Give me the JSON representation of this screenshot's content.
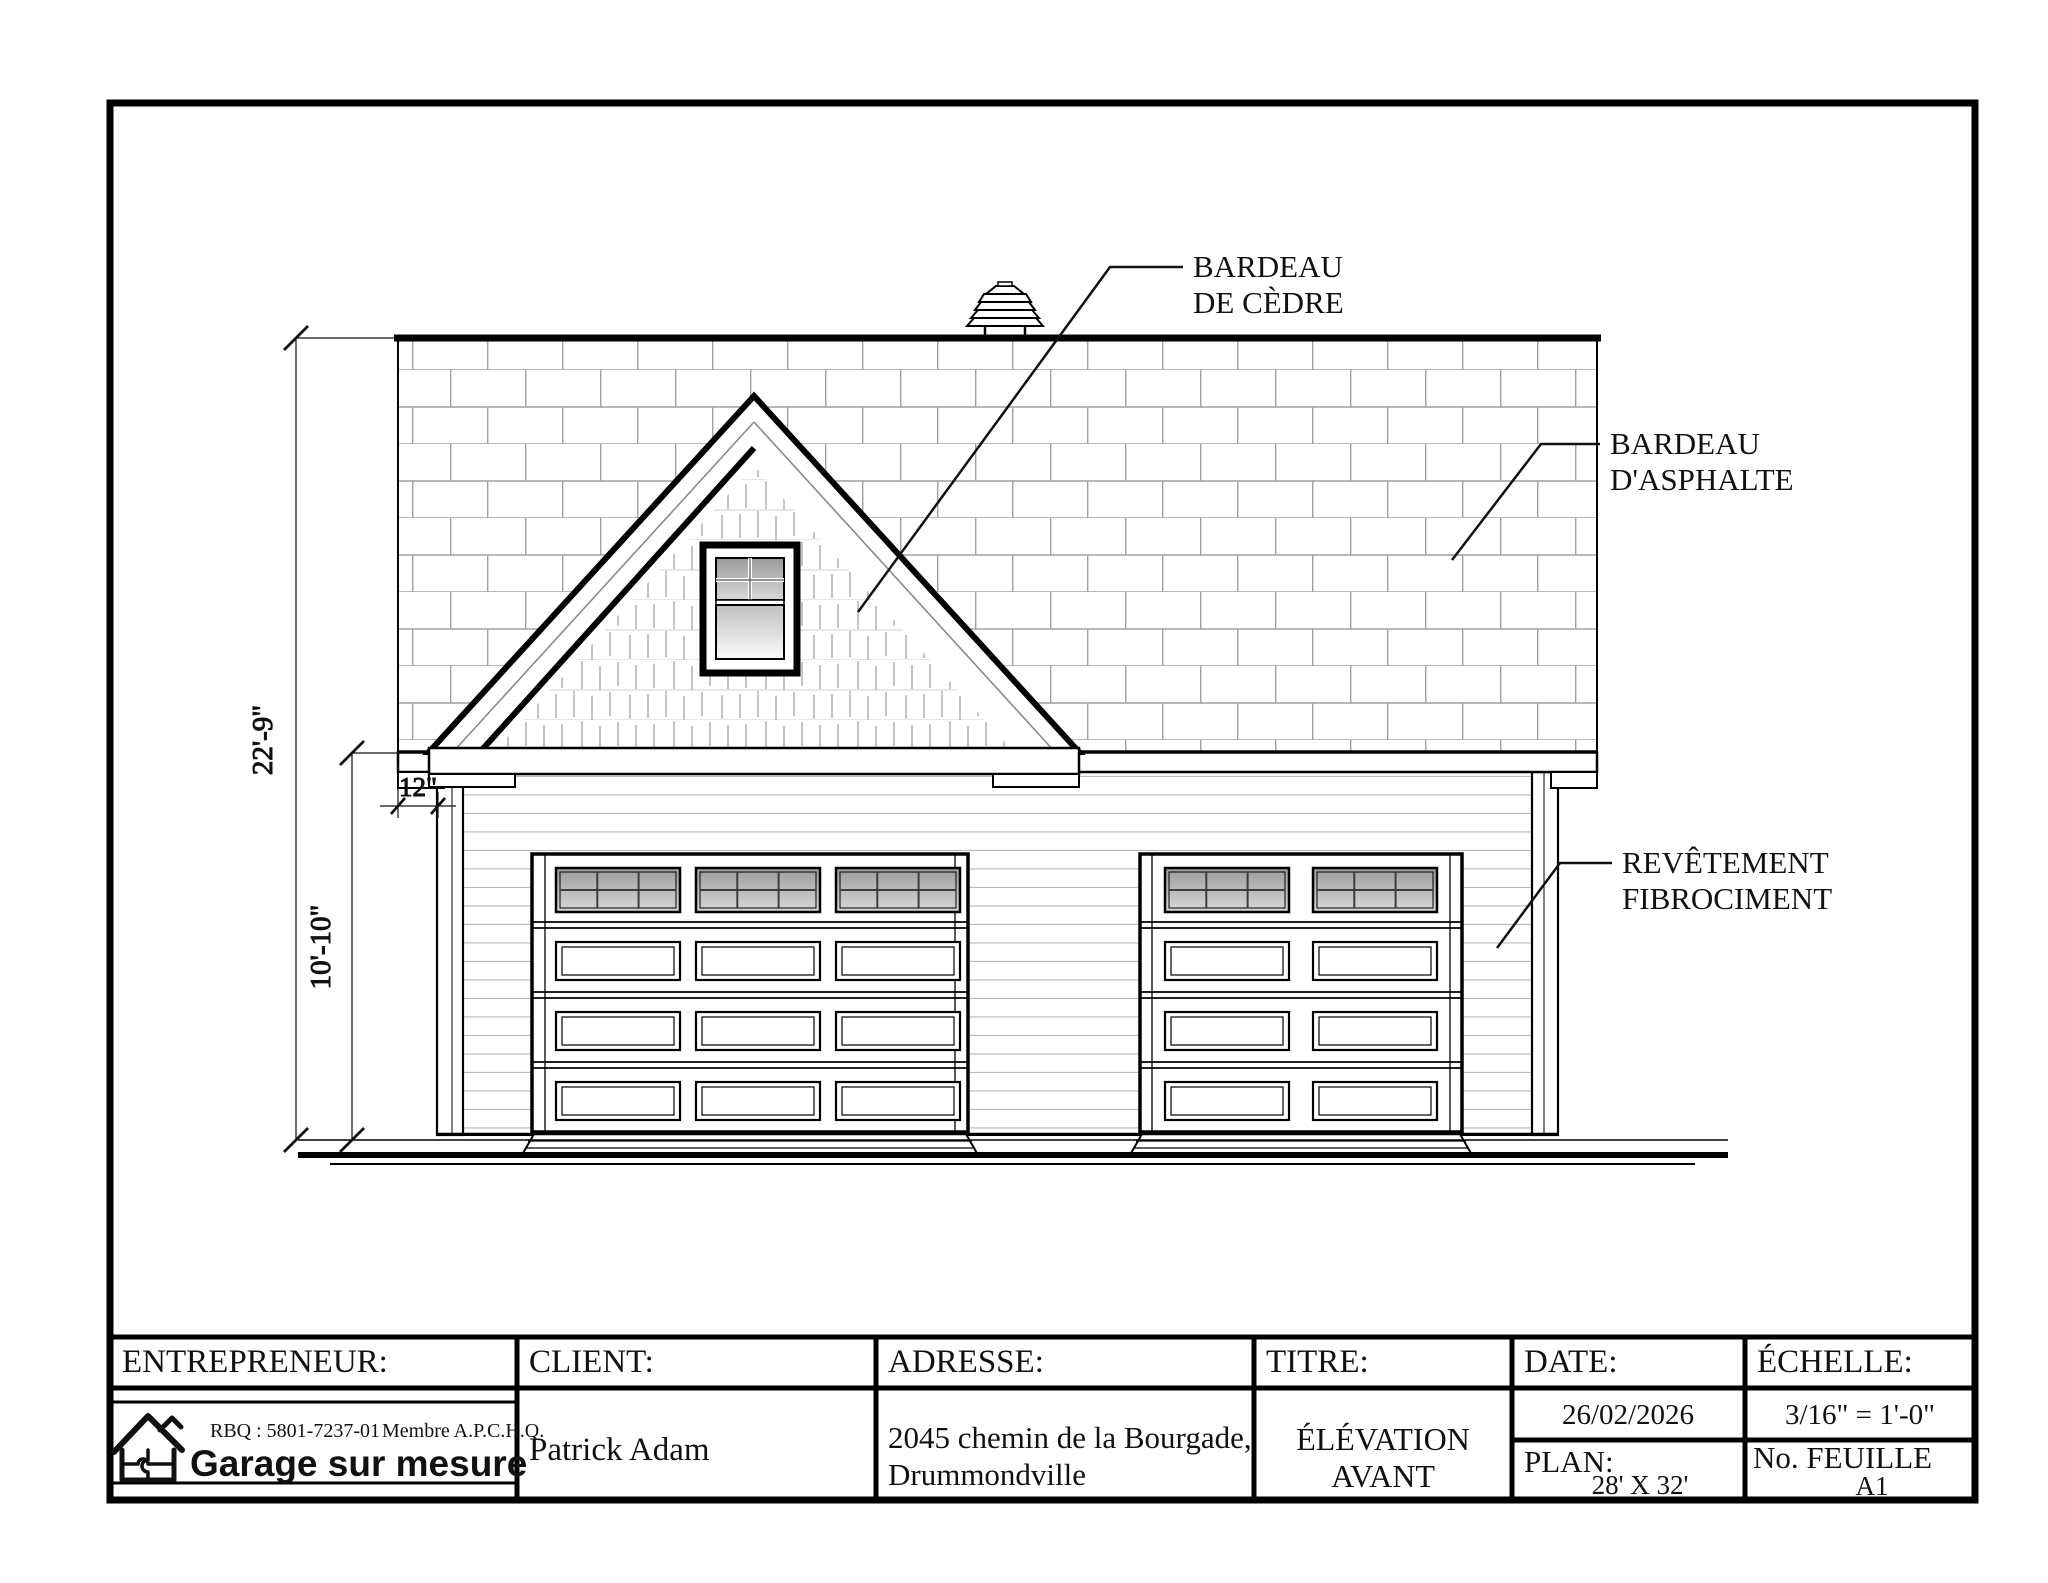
{
  "annotations": {
    "cedre_line1": "BARDEAU",
    "cedre_line2": "DE CÈDRE",
    "asphalte_line1": "BARDEAU",
    "asphalte_line2": "D'ASPHALTE",
    "fibro_line1": "REVÊTEMENT",
    "fibro_line2": "FIBROCIMENT"
  },
  "dimensions": {
    "overall_height": "22'-9\"",
    "wall_height": "10'-10\"",
    "overhang": "12\""
  },
  "title_block": {
    "entrepreneur_label": "ENTREPRENEUR:",
    "client_label": "CLIENT:",
    "adresse_label": "ADRESSE:",
    "titre_label": "TITRE:",
    "date_label": "DATE:",
    "echelle_label": "ÉCHELLE:",
    "rbq": "RBQ : 5801-7237-01",
    "membre": "Membre A.P.C.H.Q.",
    "company": "Garage sur mesure",
    "client_name": "Patrick Adam",
    "adresse_line1": "2045 chemin de la Bourgade,",
    "adresse_line2": "Drummondville",
    "titre_line1": "ÉLÉVATION",
    "titre_line2": "AVANT",
    "date_value": "26/02/2026",
    "plan_label": "PLAN:",
    "plan_value": "28' X 32'",
    "echelle_value": "3/16\" = 1'-0\"",
    "feuille_label": "No. FEUILLE",
    "feuille_value": "A1"
  },
  "colors": {
    "ink": "#111111",
    "shingle_line": "#a0a0a0",
    "siding_line": "#b8b8b8"
  }
}
